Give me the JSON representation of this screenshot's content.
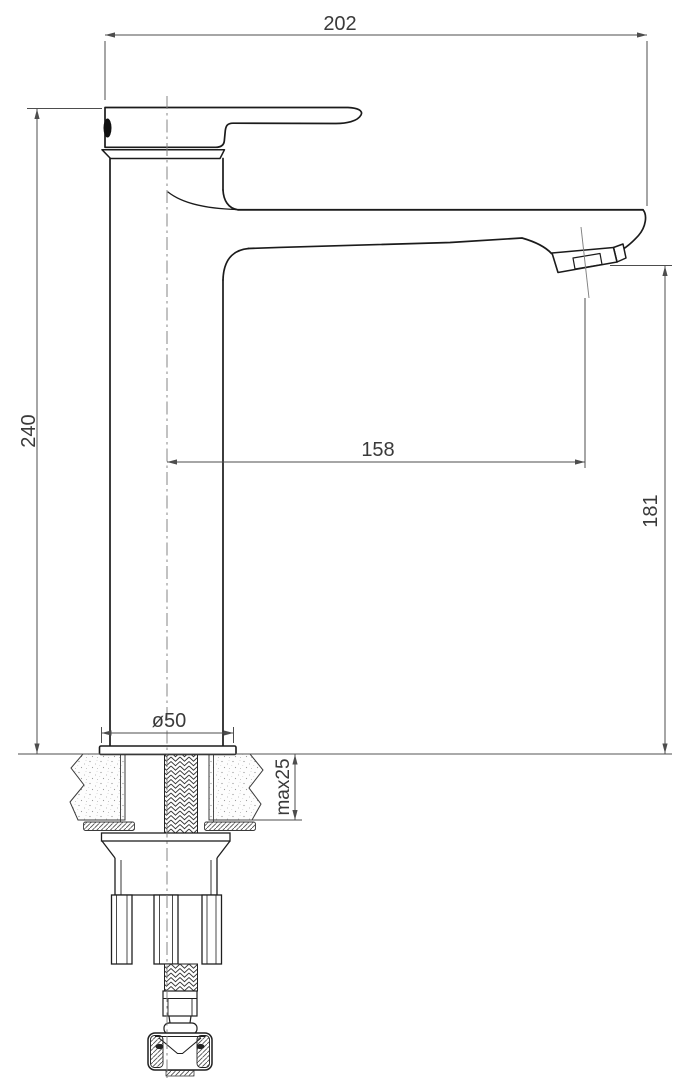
{
  "drawing": {
    "kind": "faucet-installation-dimension-drawing",
    "colors": {
      "background": "#ffffff",
      "object_line": "#1b1b1b",
      "thin_line": "#555555",
      "centerline": "#808080",
      "text": "#3a3a3a"
    },
    "labels": {
      "overall_length": "202",
      "overall_height": "240",
      "spout_reach": "158",
      "spout_outlet_height": "181",
      "base_diameter": "ø50",
      "max_mounting_thickness": "max25"
    }
  }
}
